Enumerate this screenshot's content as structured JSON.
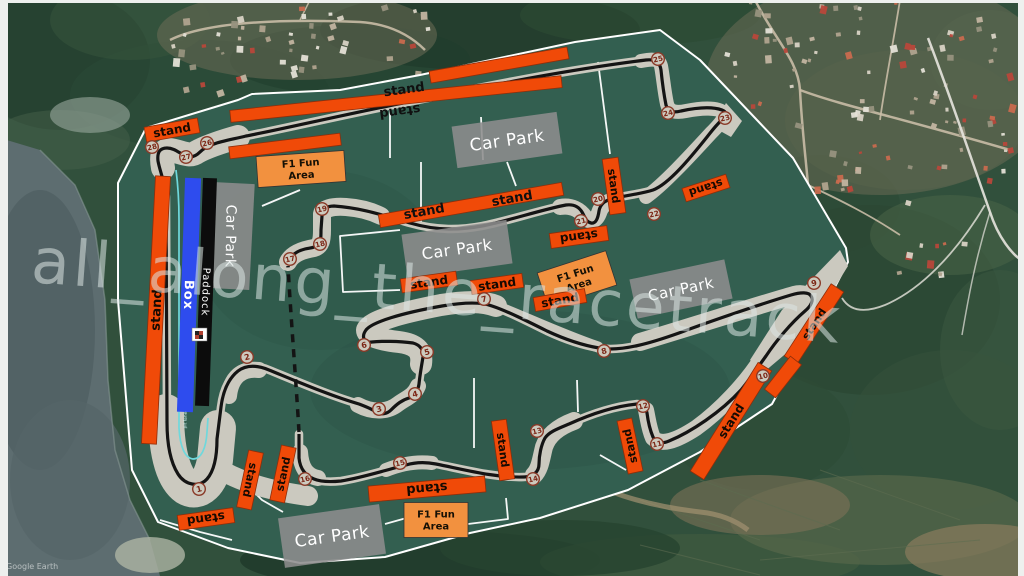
{
  "watermark_text": "all_along_the_racetrack",
  "attribution": "Google Earth",
  "labels": {
    "stand": "stand",
    "car_park": "Car Park",
    "fun_line1": "F1 Fun",
    "fun_line2": "Area",
    "paddock": "Paddock",
    "box": "Box",
    "pit_lane": "pit lane"
  },
  "colors": {
    "green": "#335f50",
    "green_shade": "#2c5346",
    "runoff": "#cbc9bf",
    "track": "#141414",
    "road_white": "#ffffff",
    "stand_fill": "#f04a08",
    "stand_border": "#8f2d0a",
    "stand_text": "#160a02",
    "fun_fill": "#f2913f",
    "fun_border": "#333333",
    "park_fill": "#8d8d8d",
    "park_text": "#ffffff",
    "pit": "#6fd8dc",
    "box_blue": "#2e4cee",
    "paddock_black": "#0c0c0c",
    "turn_fill": "#cdcabe",
    "turn_stroke": "#8a3a28",
    "turn_text": "#7c2616",
    "watermark": "#dce6e4"
  },
  "turns": [
    {
      "n": 1,
      "x": 199,
      "y": 489
    },
    {
      "n": 2,
      "x": 247,
      "y": 357
    },
    {
      "n": 3,
      "x": 379,
      "y": 409
    },
    {
      "n": 4,
      "x": 415,
      "y": 394
    },
    {
      "n": 5,
      "x": 427,
      "y": 352
    },
    {
      "n": 6,
      "x": 364,
      "y": 345
    },
    {
      "n": 7,
      "x": 484,
      "y": 299
    },
    {
      "n": 8,
      "x": 604,
      "y": 351
    },
    {
      "n": 9,
      "x": 814,
      "y": 283
    },
    {
      "n": 10,
      "x": 763,
      "y": 376
    },
    {
      "n": 11,
      "x": 657,
      "y": 444
    },
    {
      "n": 12,
      "x": 643,
      "y": 406
    },
    {
      "n": 13,
      "x": 537,
      "y": 431
    },
    {
      "n": 14,
      "x": 533,
      "y": 479
    },
    {
      "n": 15,
      "x": 400,
      "y": 463
    },
    {
      "n": 16,
      "x": 305,
      "y": 479
    },
    {
      "n": 17,
      "x": 290,
      "y": 259
    },
    {
      "n": 18,
      "x": 320,
      "y": 244
    },
    {
      "n": 19,
      "x": 322,
      "y": 209
    },
    {
      "n": 20,
      "x": 598,
      "y": 199
    },
    {
      "n": 21,
      "x": 581,
      "y": 221
    },
    {
      "n": 22,
      "x": 654,
      "y": 214
    },
    {
      "n": 23,
      "x": 725,
      "y": 118
    },
    {
      "n": 24,
      "x": 668,
      "y": 113
    },
    {
      "n": 25,
      "x": 658,
      "y": 59
    },
    {
      "n": 26,
      "x": 207,
      "y": 143
    },
    {
      "n": 27,
      "x": 186,
      "y": 157
    },
    {
      "n": 28,
      "x": 152,
      "y": 147
    }
  ],
  "stands": [
    {
      "cx": 172,
      "cy": 130,
      "w": 54,
      "h": 15,
      "rot": -10,
      "lm": "n",
      "fs": 12
    },
    {
      "cx": 396,
      "cy": 99,
      "w": 333,
      "h": 12,
      "rot": -6,
      "lm": "-",
      "fs": 0
    },
    {
      "cx": 499,
      "cy": 65,
      "w": 140,
      "h": 12,
      "rot": -10,
      "lm": "-",
      "fs": 0
    },
    {
      "cx": 285,
      "cy": 146,
      "w": 112,
      "h": 12,
      "rot": -7,
      "lm": "-",
      "fs": 0
    },
    {
      "cx": 156,
      "cy": 310,
      "w": 15,
      "h": 268,
      "rot": 3,
      "lm": "up",
      "fs": 13
    },
    {
      "cx": 206,
      "cy": 519,
      "w": 56,
      "h": 15,
      "rot": -8,
      "lm": "flip",
      "fs": 12
    },
    {
      "cx": 250,
      "cy": 480,
      "w": 15,
      "h": 58,
      "rot": 12,
      "lm": "down",
      "fs": 11
    },
    {
      "cx": 283,
      "cy": 474,
      "w": 15,
      "h": 56,
      "rot": 12,
      "lm": "up",
      "fs": 11
    },
    {
      "cx": 427,
      "cy": 489,
      "w": 117,
      "h": 16,
      "rot": -5,
      "lm": "flip",
      "fs": 13
    },
    {
      "cx": 503,
      "cy": 450,
      "w": 15,
      "h": 60,
      "rot": -8,
      "lm": "down",
      "fs": 11
    },
    {
      "cx": 630,
      "cy": 446,
      "w": 15,
      "h": 54,
      "rot": -12,
      "lm": "up",
      "fs": 11
    },
    {
      "cx": 731,
      "cy": 421,
      "w": 16,
      "h": 128,
      "rot": 32,
      "lm": "up",
      "fs": 12
    },
    {
      "cx": 814,
      "cy": 324,
      "w": 15,
      "h": 86,
      "rot": 33,
      "lm": "up",
      "fs": 11
    },
    {
      "cx": 783,
      "cy": 377,
      "w": 14,
      "h": 42,
      "rot": 38,
      "lm": "-",
      "fs": 0
    },
    {
      "cx": 471,
      "cy": 205,
      "w": 186,
      "h": 13,
      "rot": -10,
      "lm": "-",
      "fs": 0
    },
    {
      "cx": 614,
      "cy": 186,
      "w": 16,
      "h": 56,
      "rot": -8,
      "lm": "down",
      "fs": 11
    },
    {
      "cx": 579,
      "cy": 237,
      "w": 58,
      "h": 15,
      "rot": -8,
      "lm": "flip",
      "fs": 12
    },
    {
      "cx": 706,
      "cy": 188,
      "w": 46,
      "h": 14,
      "rot": -18,
      "lm": "flip",
      "fs": 11
    },
    {
      "cx": 429,
      "cy": 282,
      "w": 56,
      "h": 14,
      "rot": -8,
      "lm": "n",
      "fs": 12
    },
    {
      "cx": 497,
      "cy": 284,
      "w": 52,
      "h": 14,
      "rot": -8,
      "lm": "n",
      "fs": 12
    },
    {
      "cx": 560,
      "cy": 300,
      "w": 52,
      "h": 14,
      "rot": -10,
      "lm": "n",
      "fs": 12
    }
  ],
  "stand_labels": [
    {
      "x": 404,
      "y": 89,
      "rot": -8,
      "flip": false
    },
    {
      "x": 400,
      "y": 112,
      "rot": -8,
      "flip": true
    },
    {
      "x": 424,
      "y": 211,
      "rot": -10,
      "flip": false
    },
    {
      "x": 512,
      "y": 198,
      "rot": -10,
      "flip": false
    }
  ],
  "car_parks": [
    {
      "cx": 507,
      "cy": 140,
      "w": 106,
      "h": 42,
      "rot": -8,
      "fs": 17,
      "vert": false
    },
    {
      "cx": 231,
      "cy": 236,
      "w": 42,
      "h": 106,
      "rot": 3,
      "fs": 14,
      "vert": true
    },
    {
      "cx": 457,
      "cy": 249,
      "w": 106,
      "h": 44,
      "rot": -8,
      "fs": 16,
      "vert": false
    },
    {
      "cx": 681,
      "cy": 289,
      "w": 97,
      "h": 40,
      "rot": -12,
      "fs": 15,
      "vert": false
    },
    {
      "cx": 332,
      "cy": 536,
      "w": 102,
      "h": 50,
      "rot": -8,
      "fs": 17,
      "vert": false
    }
  ],
  "fun_areas": [
    {
      "cx": 301,
      "cy": 169,
      "w": 88,
      "h": 31,
      "rot": -4,
      "fs": 10
    },
    {
      "cx": 577,
      "cy": 279,
      "w": 72,
      "h": 36,
      "rot": -18,
      "fs": 10
    },
    {
      "cx": 436,
      "cy": 520,
      "w": 64,
      "h": 35,
      "rot": 0,
      "fs": 10
    }
  ],
  "paddock": {
    "box": {
      "cx": 189,
      "cy": 295,
      "w": 16,
      "h": 234,
      "rot": 2,
      "fs": 13
    },
    "pad": {
      "cx": 206,
      "cy": 292,
      "w": 14,
      "h": 228,
      "rot": 2,
      "fs": 10
    },
    "flag": {
      "x": 192,
      "y": 328,
      "w": 15,
      "h": 13
    },
    "pit_label": {
      "x": 185,
      "y": 420
    }
  },
  "circuit": {
    "outline": "M118,183 L146,128 L238,100 L252,94 L340,90 L420,75 L575,42 L660,30 L700,60 L793,158 L846,248 L848,262 L806,342 L772,404 L700,452 L628,490 L540,518 L470,533 L385,557 L300,563 L228,548 L158,522 L132,470 L118,300 Z",
    "roads": [
      "M390,104 L390,158",
      "M481,117 L483,160",
      "M421,162 L421,224",
      "M507,162 L516,186",
      "M262,206 L300,190",
      "M400,230 L340,236 L343,292 L400,290",
      "M474,378 L474,448",
      "M577,380 L578,412",
      "M598,62 L610,154",
      "M283,512 L262,500 L250,488",
      "M385,524 L410,517",
      "M468,524 L508,519 L506,498",
      "M600,455 L626,470",
      "M160,520 L200,532 L232,540"
    ],
    "runoff": [
      {
        "d": "M238,137 C224,141 206,147 197,152 C189,158 181,151 169,150 C162,150 161,157 163,168",
        "w": 24
      },
      {
        "d": "M166,412 C166,448 172,477 186,487 C199,495 211,483 215,460 L218,428",
        "w": 36
      },
      {
        "d": "M214,466 C244,485 279,492 308,496",
        "w": 20
      },
      {
        "d": "M229,396 C231,377 242,368 259,370",
        "w": 16
      },
      {
        "d": "M358,405 C373,413 388,412 398,404 C406,398 414,396 418,386",
        "w": 16
      },
      {
        "d": "M421,364 C423,350 415,344 399,342 C381,340 367,336 367,330 C371,321 400,313 441,305 C466,301 483,301 496,306",
        "w": 22
      },
      {
        "d": "M496,306 C520,315 560,334 598,347",
        "w": 11
      },
      {
        "d": "M640,342 C700,324 762,304 794,295 C806,292 812,298 806,308 C791,324 774,344 758,366",
        "w": 18
      },
      {
        "d": "M762,358 C746,383 721,410 696,428 C676,441 661,446 653,438 C649,429 648,419 646,410",
        "w": 16
      },
      {
        "d": "M574,421 C558,427 548,435 544,447 C541,459 540,469 534,475",
        "w": 18
      },
      {
        "d": "M432,463 C417,461 401,464 386,470",
        "w": 14
      },
      {
        "d": "M318,478 C307,476 301,468 300,452",
        "w": 16
      },
      {
        "d": "M288,262 C292,254 302,250 314,248 C321,246 322,240 322,230 L322,214 C323,209 331,206 346,207 C361,208 373,212 381,216",
        "w": 18
      },
      {
        "d": "M560,207 C572,205 580,210 585,217 C590,223 596,221 599,213 C601,206 607,201 615,200",
        "w": 16
      },
      {
        "d": "M646,197 C663,185 689,157 711,133 C719,125 725,119 724,113 C718,107 701,108 686,111 C676,113 669,112 667,104 C664,90 663,76 661,66 C659,58 651,59 641,61",
        "w": 14
      }
    ],
    "runoff_polys": [
      "M840,250 L848,266 L802,340 L764,372 L750,360 L782,310 Z",
      "M726,103 L742,121 L731,137 L713,127 Z"
    ],
    "track_solid": "M288,262 C291,255 297,251 305,249 C309,248 315,248 318,245 C321,242 321,237 321,230 L322,216 C322,210 326,206 334,206 C362,208 382,215 410,223 C438,231 460,230 482,226 C504,222 544,209 566,205 C574,204 579,207 582,212 C585,217 586,222 591,223 C596,224 598,218 599,211 C600,205 604,201 611,199 C627,195 641,194 653,190 C669,184 691,157 707,137 C714,128 718,123 723,119 C727,115 727,112 722,110 C711,106 695,108 681,111 C673,113 668,112 666,105 C664,95 662,80 661,70 C660,62 655,59 646,60 C558,71 478,88 398,104 C338,116 278,130 246,136 C234,139 222,141 214,144 C208,146 204,148 200,152 C196,156 191,158 186,156 C180,154 175,148 167,148 C160,148 157,152 158,161 C160,172 165,182 166,197 L167,422 C167,445 171,463 178,474 C185,485 199,488 207,479 C214,471 217,457 217,439 L221,407 C223,391 228,379 238,371 C246,365 257,365 269,370 C296,381 331,396 359,404 C367,407 372,409 376,412 C381,415 387,414 391,410 C397,404 402,400 409,398 C415,396 418,391 419,384 C420,374 422,363 423,357 C424,350 420,345 413,343 C398,341 381,341 372,342 C364,343 361,337 366,330 C372,322 402,313 442,306 C466,302 482,302 492,306 C507,311 527,321 547,331 C562,338 581,345 599,348 C621,352 651,343 679,333 C711,321 761,304 791,295 C801,292 809,292 811,296 C814,300 811,306 805,311 C791,323 776,341 766,356 C758,367 750,379 741,390 C721,412 691,432 669,441 C662,444 656,443 653,437 C650,430 648,421 647,413 C646,408 643,404 637,404 C616,406 591,414 569,424 C557,429 549,432 545,438 C541,445 539,456 539,464 C539,472 533,477 524,477 C496,478 466,470 436,464 C426,462 416,462 406,465 C386,470 361,478 341,481 C331,482 321,482 314,479 C306,476 300,469 299,458 L299,434",
    "track_dashed": "M299,432 C296,380 291,320 288,266",
    "pit_lane": "M176,170 C178,185 179,200 179,220 L179,428 C180,447 185,458 193,459 C201,459 206,449 207,432 L208,418"
  }
}
